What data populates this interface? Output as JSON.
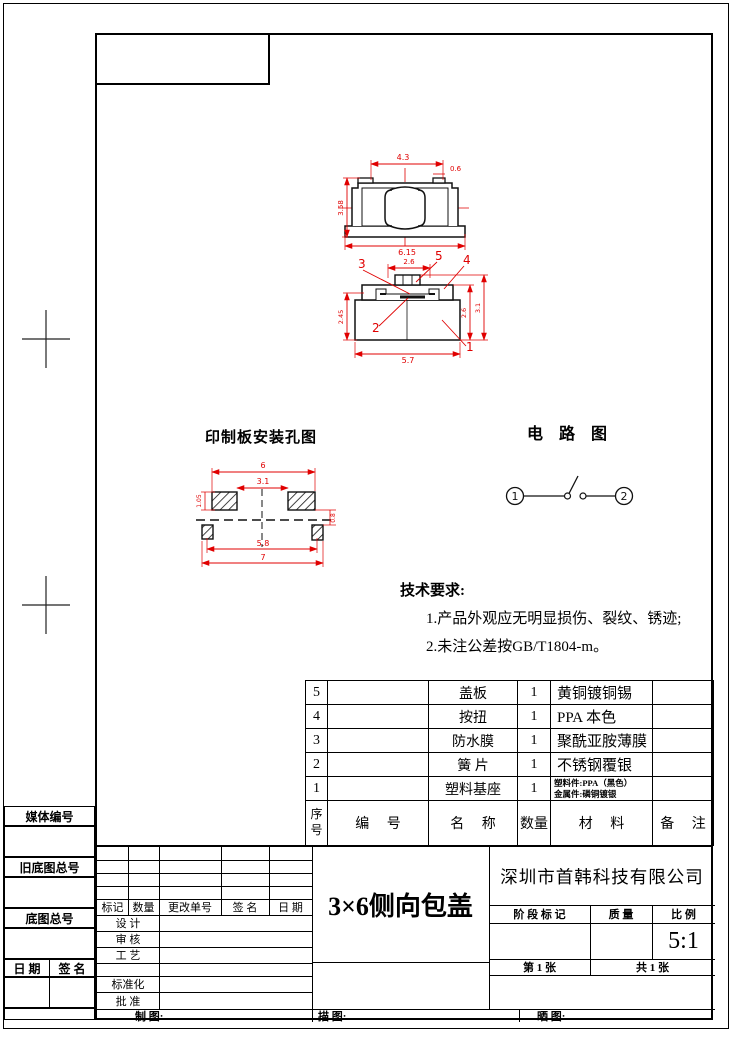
{
  "accent_colors": {
    "dimension_red": "#e00000",
    "line_black": "#000000"
  },
  "drawings": {
    "top_view": {
      "dims": {
        "top_width": "4.3",
        "tab_width": "0.6",
        "height": "3.58",
        "bottom_width": "6.15"
      }
    },
    "section_view": {
      "dims": {
        "top": "2.6",
        "bottom": "5.7",
        "left": "2.45",
        "right_inner": "2.6",
        "right_outer": "3.1"
      },
      "callouts": {
        "c1": "1",
        "c2": "2",
        "c3": "3",
        "c4": "4",
        "c5": "5"
      }
    },
    "pcb": {
      "title": "印制板安装孔图",
      "dims": {
        "outer_top": "6",
        "inner_top": "3.1",
        "inner_bottom": "5.8",
        "outer_bottom": "7",
        "pad_h": "1.05",
        "offset": "0.8"
      }
    },
    "circuit": {
      "title": "电 路 图",
      "terminal1": "1",
      "terminal2": "2"
    }
  },
  "tech_req": {
    "title": "技术要求:",
    "line1": "1.产品外观应无明显损伤、裂纹、锈迹;",
    "line2": "2.未注公差按GB/T1804-m。"
  },
  "bom": {
    "headers": {
      "seq": "序号",
      "code": "编 号",
      "name": "名 称",
      "qty": "数量",
      "material": "材 料",
      "note": "备 注"
    },
    "rows": [
      {
        "seq": "5",
        "code": "",
        "name": "盖板",
        "qty": "1",
        "material": "黄铜镀铜锡",
        "note": ""
      },
      {
        "seq": "4",
        "code": "",
        "name": "按扭",
        "qty": "1",
        "material": "PPA 本色",
        "note": ""
      },
      {
        "seq": "3",
        "code": "",
        "name": "防水膜",
        "qty": "1",
        "material": "聚酰亚胺薄膜",
        "note": ""
      },
      {
        "seq": "2",
        "code": "",
        "name": "簧 片",
        "qty": "1",
        "material": "不锈钢覆银",
        "note": ""
      },
      {
        "seq": "1",
        "code": "",
        "name": "塑料基座",
        "qty": "1",
        "material_line1": "塑料件:PPA（黑色）",
        "material_line2": "金属件:磷铜镀银",
        "note": ""
      }
    ]
  },
  "title_block": {
    "rev_headers": {
      "mark": "标记",
      "qty": "数量",
      "order": "更改单号",
      "sign": "签 名",
      "date": "日 期"
    },
    "left_rows": {
      "design": "设 计",
      "check": "审 核",
      "process": "工 艺",
      "std": "标准化",
      "approve": "批 准"
    },
    "drawing_title": "3×6侧向包盖",
    "company": "深圳市首韩科技有限公司",
    "stage_header": {
      "stage": "阶 段 标 记",
      "quality": "质 量",
      "scale_label": "比 例"
    },
    "scale_value": "5:1",
    "sheet": "第 1 张",
    "sheets_total": "共 1 张",
    "bottom_labels": {
      "draft": "制 图:",
      "trace": "描 图:",
      "print": "晒 图:"
    }
  },
  "margin": {
    "label1": "媒体编号",
    "label2": "旧底图总号",
    "label3": "底图总号",
    "date_label": "日 期",
    "sign_label": "签 名"
  }
}
